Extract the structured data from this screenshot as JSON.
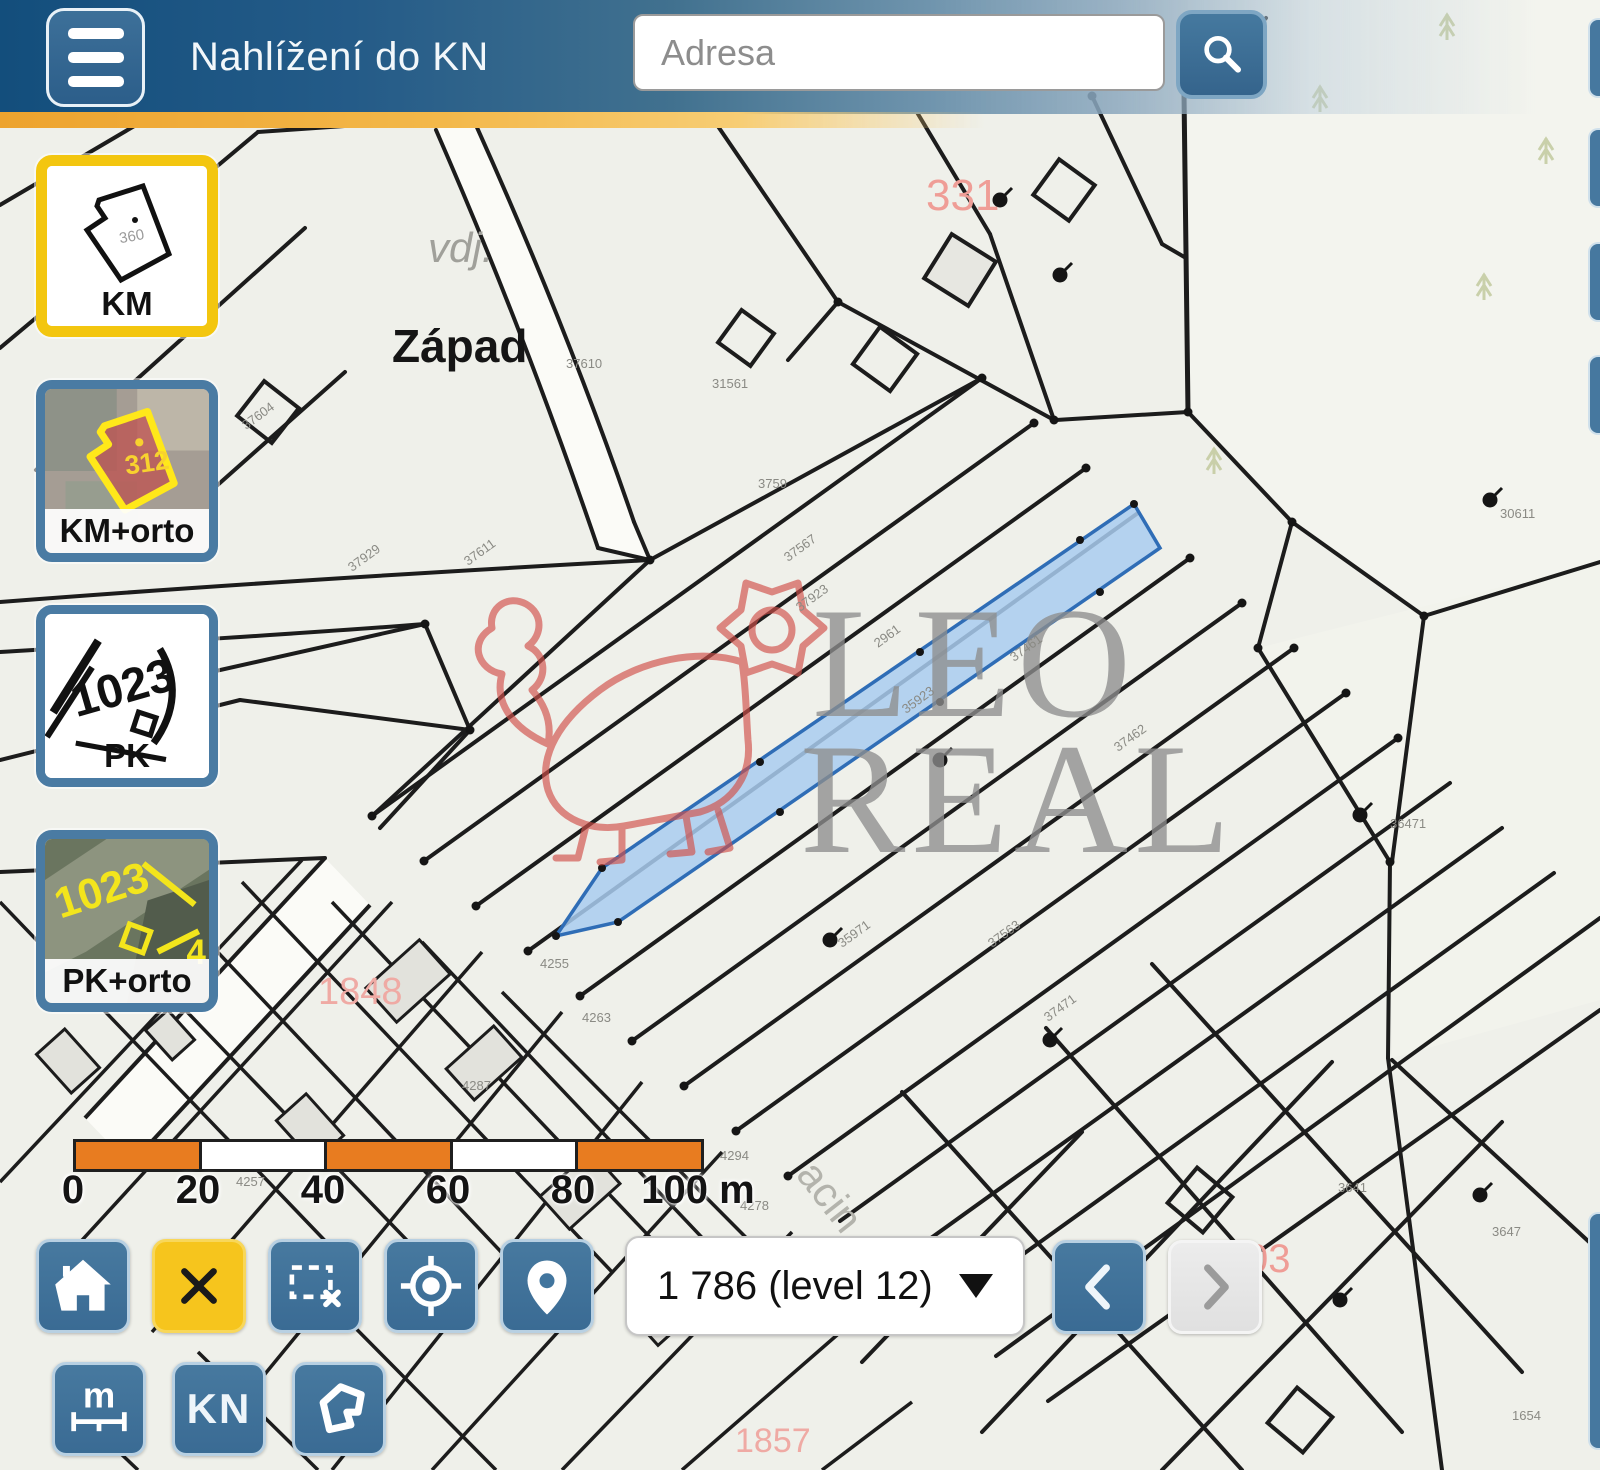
{
  "header": {
    "title": "Nahlížení do KN",
    "menu_icon": "hamburger-icon",
    "search": {
      "placeholder": "Adresa",
      "button_icon": "search-icon"
    }
  },
  "layers": {
    "items": [
      {
        "id": "km",
        "label": "KM",
        "thumb_number": "360",
        "selected": true
      },
      {
        "id": "km-orto",
        "label": "KM+orto",
        "thumb_number": "312",
        "selected": false
      },
      {
        "id": "pk",
        "label": "PK",
        "thumb_number": "1023",
        "selected": false
      },
      {
        "id": "pk-orto",
        "label": "PK+orto",
        "thumb_number": "1023",
        "selected": false
      }
    ],
    "selected_border_color": "#f3c60f",
    "normal_border_color": "#4a7ba3"
  },
  "map": {
    "labels": [
      {
        "text": "Západ",
        "x": 392,
        "y": 362,
        "size": 46,
        "color": "#151515",
        "bold": true
      },
      {
        "text": "vdj.",
        "x": 428,
        "y": 262,
        "size": 42,
        "color": "#a0a09a",
        "italic": true
      },
      {
        "text": "331",
        "x": 926,
        "y": 210,
        "size": 44,
        "color": "#ef9d96"
      },
      {
        "text": "03",
        "x": 1246,
        "y": 1272,
        "size": 40,
        "color": "#ef9d96"
      },
      {
        "text": "1848",
        "x": 318,
        "y": 1004,
        "size": 38,
        "color": "#efaaa4"
      },
      {
        "text": "1857",
        "x": 735,
        "y": 1452,
        "size": 34,
        "color": "#efaaa4"
      },
      {
        "text": "acin",
        "x": 795,
        "y": 1175,
        "size": 42,
        "color": "#b3b3ac",
        "rotate": 52
      }
    ],
    "parcel_numbers": [
      {
        "text": "37929",
        "x": 352,
        "y": 572,
        "rotate": -36
      },
      {
        "text": "37611",
        "x": 468,
        "y": 566,
        "rotate": -36
      },
      {
        "text": "37604",
        "x": 246,
        "y": 430,
        "rotate": -36
      },
      {
        "text": "37610",
        "x": 566,
        "y": 368,
        "rotate": 0
      },
      {
        "text": "31561",
        "x": 712,
        "y": 388,
        "rotate": 0
      },
      {
        "text": "3759",
        "x": 758,
        "y": 488,
        "rotate": 0
      },
      {
        "text": "37567",
        "x": 788,
        "y": 562,
        "rotate": -36
      },
      {
        "text": "37923",
        "x": 800,
        "y": 612,
        "rotate": -36
      },
      {
        "text": "37461",
        "x": 1014,
        "y": 662,
        "rotate": -36
      },
      {
        "text": "2961",
        "x": 878,
        "y": 648,
        "rotate": -36
      },
      {
        "text": "37462",
        "x": 1118,
        "y": 752,
        "rotate": -36
      },
      {
        "text": "35923",
        "x": 906,
        "y": 714,
        "rotate": -36
      },
      {
        "text": "35971",
        "x": 842,
        "y": 948,
        "rotate": -36
      },
      {
        "text": "37471",
        "x": 1048,
        "y": 1022,
        "rotate": -36
      },
      {
        "text": "37563",
        "x": 992,
        "y": 948,
        "rotate": -36
      },
      {
        "text": "4255",
        "x": 540,
        "y": 968,
        "rotate": 0
      },
      {
        "text": "4263",
        "x": 582,
        "y": 1022,
        "rotate": 0
      },
      {
        "text": "4287",
        "x": 462,
        "y": 1090,
        "rotate": 0
      },
      {
        "text": "4294",
        "x": 720,
        "y": 1160,
        "rotate": 0
      },
      {
        "text": "4278",
        "x": 740,
        "y": 1210,
        "rotate": 0
      },
      {
        "text": "4257",
        "x": 236,
        "y": 1186,
        "rotate": 0
      },
      {
        "text": "36471",
        "x": 1390,
        "y": 828,
        "rotate": 0
      },
      {
        "text": "30611",
        "x": 1500,
        "y": 518,
        "rotate": 0
      },
      {
        "text": "3641",
        "x": 1338,
        "y": 1192,
        "rotate": 0
      },
      {
        "text": "3647",
        "x": 1492,
        "y": 1236,
        "rotate": 0
      },
      {
        "text": "3654",
        "x": 686,
        "y": 1290,
        "rotate": 0
      },
      {
        "text": "1654",
        "x": 1512,
        "y": 1420,
        "rotate": 0
      }
    ],
    "region_label_color": "#8a8a84",
    "highlight_parcel_fill": "#a9cdf0",
    "highlight_parcel_border": "#2f6db6",
    "line_color": "#1c1c1c"
  },
  "watermark": {
    "line1": "LEO",
    "line2": "REAL",
    "text_color": "#8d8d8d",
    "lion_color": "#d1504b"
  },
  "scalebar": {
    "labels": [
      {
        "text": "0",
        "x": 73
      },
      {
        "text": "20",
        "x": 198
      },
      {
        "text": "40",
        "x": 323
      },
      {
        "text": "60",
        "x": 448
      },
      {
        "text": "80",
        "x": 573
      },
      {
        "text": "100 m",
        "x": 698
      }
    ],
    "bar_color": "#e87c20"
  },
  "toolbar": {
    "home_icon": "home-icon",
    "close_icon": "close-x-icon",
    "selection_icon": "selection-rect-icon",
    "locate_icon": "locate-icon",
    "pin_icon": "map-pin-icon",
    "zoom_select": {
      "value": "1 786 (level 12)"
    },
    "back_icon": "chevron-left-icon",
    "forward_icon": "chevron-right-icon",
    "measure_label": "m",
    "kn_label": "KN",
    "polygon_icon": "polygon-icon"
  },
  "colors": {
    "button_blue": "#41759e",
    "accent_yellow": "#f6c51d",
    "header_blue": "#134e7c"
  }
}
